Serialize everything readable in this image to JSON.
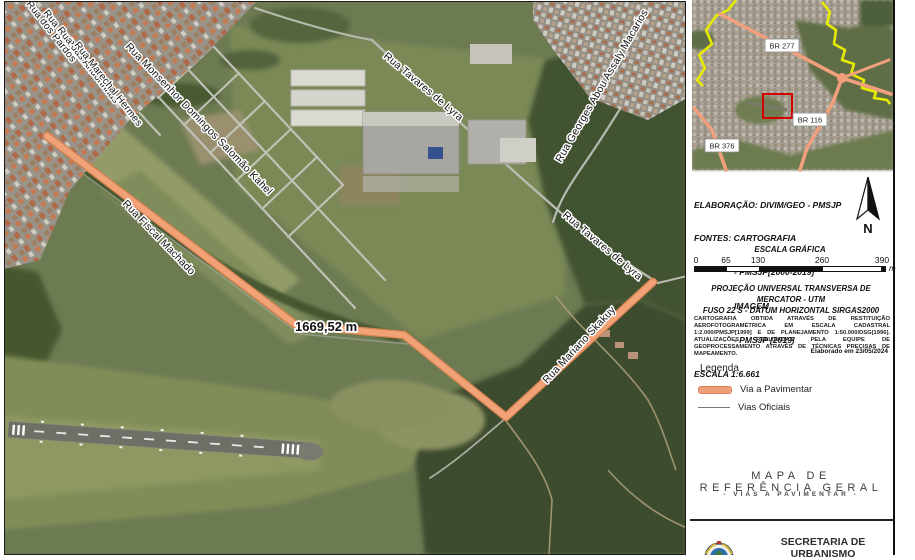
{
  "map": {
    "distance_label": "1669,52 m",
    "street_labels": [
      {
        "text": "Rua dos Pardos"
      },
      {
        "text": "Rua do Rouxinol"
      },
      {
        "text": "Rua das Andorinhas"
      },
      {
        "text": "Rua Marechal Hermes"
      },
      {
        "text": "Rua Monsenhor Domingos Salomão Kahel"
      },
      {
        "text": "Rua Tavares de Lyra"
      },
      {
        "text": "Rua Georges Abou Assaly Macarios"
      },
      {
        "text": "Rua Tavares de Lyra"
      },
      {
        "text": "Rua Fiscal Machado"
      },
      {
        "text": "Rua Mariano Skakuy"
      }
    ],
    "colors": {
      "via_pavimentar": "#f2a277"
    }
  },
  "inset": {
    "labels": [
      {
        "text": "BR 277"
      },
      {
        "text": "BR 116"
      },
      {
        "text": "BR 376"
      }
    ],
    "colors": {
      "highway": "#f0a07c",
      "boundary": "#e6ec00",
      "extent_box": "#d40000"
    }
  },
  "info": {
    "elaboracao_lines": [
      "ELABORAÇÃO: DIVIM/GEO - PMSJP",
      "FONTES: CARTOGRAFIA",
      "- PMSJP[2000-2019]",
      "IMAGEM",
      "- PMSJP [2019]",
      "ESCALA 1:6.661"
    ],
    "north_label": "N",
    "escala_grafica_title": "ESCALA GRÁFICA",
    "scalebar": {
      "ticks": [
        "0",
        "65",
        "130",
        "260",
        "390"
      ],
      "unit": "m"
    },
    "projection_line1": "PROJEÇÃO UNIVERSAL TRANSVERSA DE MERCATOR - UTM",
    "projection_line2": "FUSO 22 S - DATUM HORIZONTAL SIRGAS2000",
    "fine_print": "CARTOGRAFIA OBTIDA ATRAVÉS DE RESTITUIÇÃO AEROFOTOGRAMÉTRICA EM ESCALA CADASTRAL 1:2.000/PMSJP[1999] E DE PLANEJAMENTO 1:50.000/DSG[1996]. ATUALIZAÇÕES REALIZADAS PELA EQUIPE DE GEOPROCESSAMENTO ATRAVÉS DE TÉCNICAS PRECISAS DE MAPEAMENTO.",
    "elaborado_em": "Elaborado em 23/05/2024"
  },
  "legend": {
    "title": "Legenda",
    "items": [
      {
        "label": "Via a Pavimentar"
      },
      {
        "label": "Vias Oficiais"
      }
    ]
  },
  "title_block": {
    "title": "MAPA DE REFERÊNCIA GERAL",
    "subtitle": "-  VIAS A PAVIMENTAR  -"
  },
  "footer": {
    "org": "SECRETARIA DE URBANISMO"
  }
}
